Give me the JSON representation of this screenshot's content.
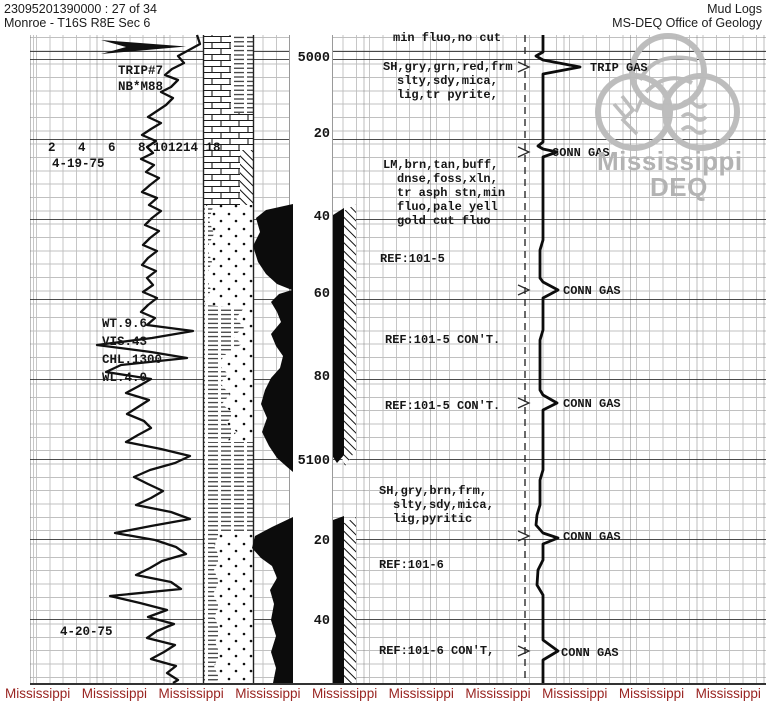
{
  "header": {
    "doc_id": "23095201390000 : 27 of 34",
    "location": "Monroe - T16S R8E Sec 6",
    "title": "Mud Logs",
    "agency": "MS-DEQ Office of Geology"
  },
  "left_track": {
    "trip_note_line1": "TRIP#7",
    "trip_note_line2": "NB*M88",
    "scale_row": "2   4   6   8 101214 18",
    "date_top": "4-19-75",
    "date_bottom": "4-20-75",
    "mud_data": [
      "WT.9.6",
      "VIS.43",
      "CHL.1300",
      "WL.4.0"
    ]
  },
  "depth": {
    "labels": [
      "5000",
      "20",
      "40",
      "60",
      "80",
      "5100",
      "20",
      "40"
    ]
  },
  "desc": [
    "min fluo,no cut",
    "SH,gry,grn,red,frm",
    "slty,sdy,mica,",
    "lig,tr pyrite,",
    "LM,brn,tan,buff,",
    "dnse,foss,xln,",
    "tr asph stn,min",
    "fluo,pale yell",
    "gold cut fluo",
    "REF:101-5",
    "REF:101-5 CON'T.",
    "REF:101-5 CON'T.",
    "SH,gry,brn,frm,",
    "slty,sdy,mica,",
    "lig,pyritic",
    "REF:101-6",
    "REF:101-6 CON'T,"
  ],
  "gas": {
    "labels": [
      "TRIP GAS",
      "CONN GAS",
      "CONN GAS",
      "CONN GAS",
      "CONN GAS",
      "CONN GAS"
    ]
  },
  "watermark": {
    "logo_line1": "Mississippi",
    "logo_line2": "DEQ",
    "bottom_word": "Mississippi"
  },
  "colors": {
    "ink": "#161616",
    "watermark_red": "#992421",
    "watermark_gray": "#b3b3b3",
    "grid_light": "#c4c4c4",
    "grid_heavy": "#3c3c3c"
  }
}
